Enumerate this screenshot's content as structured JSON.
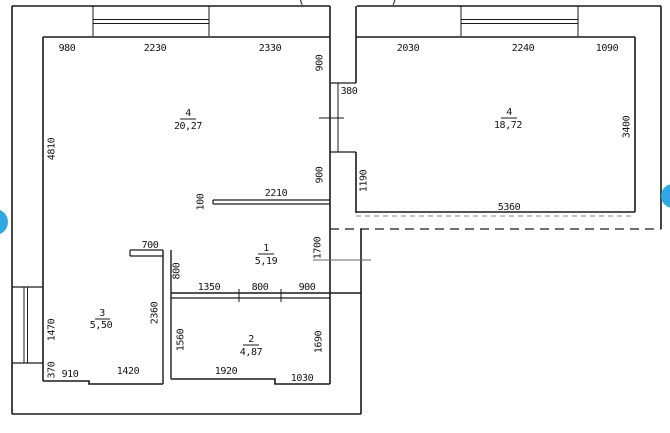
{
  "title_fragment": {
    "open": "(",
    "close": ")"
  },
  "rooms": [
    {
      "num": "4",
      "area": "20,27"
    },
    {
      "num": "4",
      "area": "18,72"
    },
    {
      "num": "1",
      "area": "5,19"
    },
    {
      "num": "2",
      "area": "4,87"
    },
    {
      "num": "3",
      "area": "5,50"
    }
  ],
  "dims": {
    "w980": "980",
    "w2230": "2230",
    "w2330": "2330",
    "w2030": "2030",
    "w2240": "2240",
    "w1090": "1090",
    "v4810": "4810",
    "v900a": "900",
    "v900b": "900",
    "w380": "380",
    "v3400": "3400",
    "v1190": "1190",
    "w5360": "5360",
    "w2210": "2210",
    "v100": "100",
    "v1700": "1700",
    "w700": "700",
    "v800": "800",
    "w1350": "1350",
    "w800": "800",
    "w900": "900",
    "v2360": "2360",
    "v1560": "1560",
    "v1690": "1690",
    "v1470": "1470",
    "v370": "370",
    "w910": "910",
    "w1420": "1420",
    "w1920": "1920",
    "w1030": "1030"
  },
  "colors": {
    "line": "#1a1a1a",
    "gallery_accent": "#2fa9e2",
    "background": "#ffffff"
  }
}
